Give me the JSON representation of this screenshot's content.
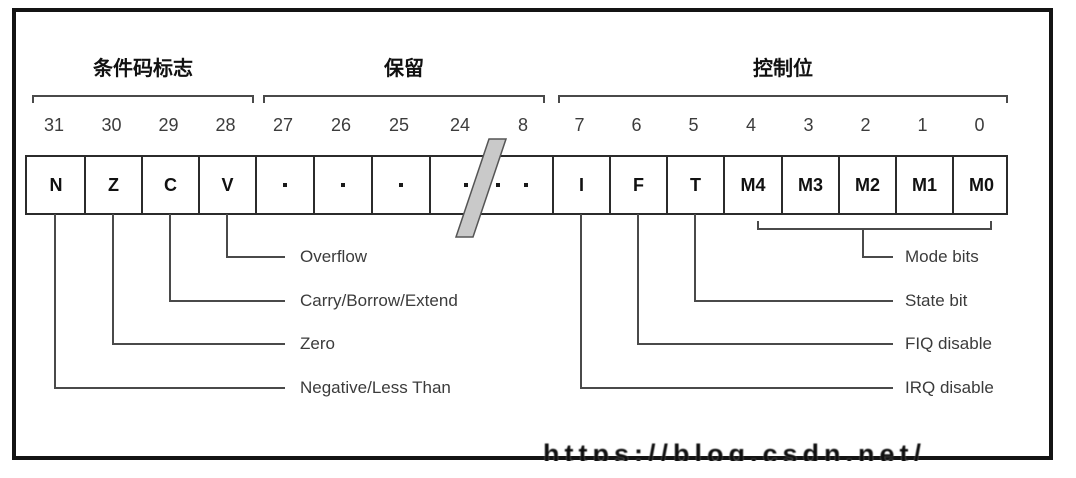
{
  "groups": [
    {
      "name": "condition-code-flags",
      "label": "条件码标志"
    },
    {
      "name": "reserved",
      "label": "保留"
    },
    {
      "name": "control-bits",
      "label": "控制位"
    }
  ],
  "bit_numbers": [
    "31",
    "30",
    "29",
    "28",
    "27",
    "26",
    "25",
    "24",
    "8",
    "7",
    "6",
    "5",
    "4",
    "3",
    "2",
    "1",
    "0"
  ],
  "cells": [
    {
      "type": "flag",
      "label": "N"
    },
    {
      "type": "flag",
      "label": "Z"
    },
    {
      "type": "flag",
      "label": "C"
    },
    {
      "type": "flag",
      "label": "V"
    },
    {
      "type": "dot",
      "label": "."
    },
    {
      "type": "dot",
      "label": "."
    },
    {
      "type": "dot",
      "label": "."
    },
    {
      "type": "break",
      "label": ". . ."
    },
    {
      "type": "ctrl",
      "label": "I"
    },
    {
      "type": "ctrl",
      "label": "F"
    },
    {
      "type": "ctrl",
      "label": "T"
    },
    {
      "type": "ctrl",
      "label": "M4"
    },
    {
      "type": "ctrl",
      "label": "M3"
    },
    {
      "type": "ctrl",
      "label": "M2"
    },
    {
      "type": "ctrl",
      "label": "M1"
    },
    {
      "type": "ctrl",
      "label": "M0"
    }
  ],
  "annotations_left": [
    {
      "bit": "V",
      "label": "Overflow"
    },
    {
      "bit": "C",
      "label": "Carry/Borrow/Extend"
    },
    {
      "bit": "Z",
      "label": "Zero"
    },
    {
      "bit": "N",
      "label": "Negative/Less Than"
    }
  ],
  "annotations_right": [
    {
      "bit": "M4-M0",
      "label": "Mode bits"
    },
    {
      "bit": "T",
      "label": "State bit"
    },
    {
      "bit": "F",
      "label": "FIQ disable"
    },
    {
      "bit": "I",
      "label": "IRQ disable"
    }
  ],
  "watermark": "https://blog.csdn.net/",
  "colors": {
    "frame": "#141414",
    "cell_border": "#2b2b2b",
    "line": "#4a4a4a",
    "text": "#3b3b3b",
    "break_fill": "#c9c9c9"
  }
}
